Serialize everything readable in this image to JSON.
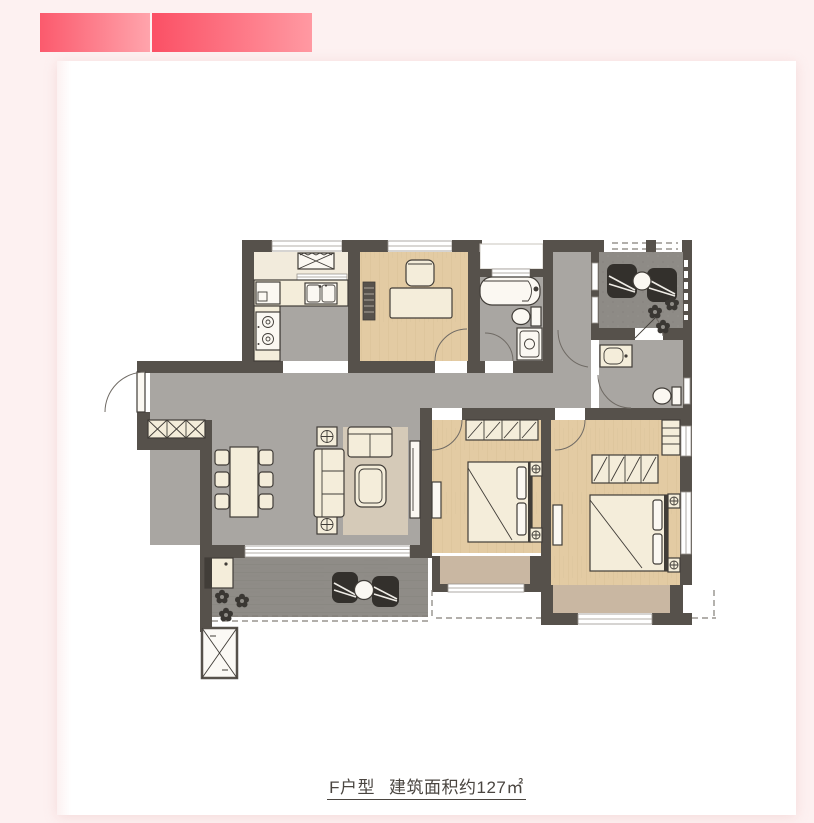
{
  "theme": {
    "page_bg": "#fdf1f1",
    "card_bg": "#ffffff",
    "banner1_from": "#fb5a6d",
    "banner1_to": "#ffa4ac",
    "banner2_from": "#fb5065",
    "banner2_to": "#ff99a2",
    "caption_color": "#4a4540",
    "wall_color": "#56514b",
    "floor_gray": "#a9a6a2",
    "floor_cream": "#f2ebdc",
    "furniture_fill": "#f4edda",
    "furniture_stroke": "#413d38",
    "rug": "#d5cab8",
    "bay_seat": "#c9b7a2"
  },
  "caption": {
    "unit": "F户型",
    "area": "建筑面积约127㎡"
  }
}
